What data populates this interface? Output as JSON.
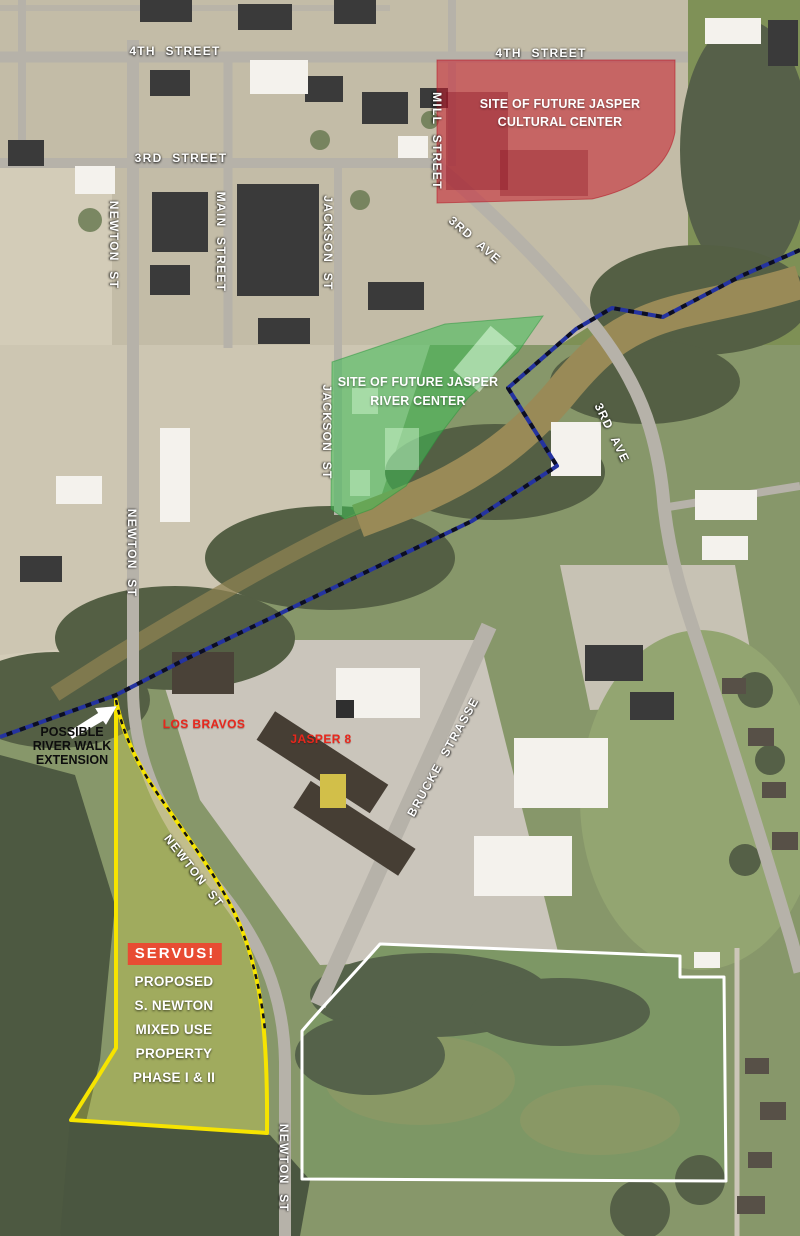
{
  "canvas": {
    "width": 800,
    "height": 1236
  },
  "streets": {
    "fourth_street_west": "4TH STREET",
    "fourth_street_east": "4TH STREET",
    "third_street": "3RD STREET",
    "mill_street": "MILL STREET",
    "main_street": "MAIN STREET",
    "jackson_st_north": "JACKSON ST",
    "jackson_st_south": "JACKSON ST",
    "newton_st_north": "NEWTON ST",
    "newton_st_mid": "NEWTON ST",
    "newton_st_curve": "NEWTON ST",
    "newton_st_south": "NEWTON ST",
    "third_ave_north": "3RD AVE",
    "third_ave_south": "3RD AVE",
    "brucke_strasse": "BRUCKE STRASSE"
  },
  "sites": {
    "cultural_center": {
      "line1": "SITE OF FUTURE JASPER",
      "line2": "CULTURAL CENTER",
      "fill_color": "#c41f30"
    },
    "river_center": {
      "line1": "SITE OF FUTURE JASPER",
      "line2": "RIVER CENTER",
      "fill_color": "#2eb44b"
    },
    "mixed_use_property": {
      "badge": "SERVUS!",
      "badge_color": "#e84c33",
      "lines": [
        "PROPOSED",
        "S. NEWTON",
        "MIXED USE",
        "PROPERTY",
        "PHASE I & II"
      ],
      "outline_color": "#f6e400"
    },
    "white_parcel": {
      "outline_color": "#ffffff"
    }
  },
  "river_walk": {
    "label_line1": "POSSIBLE",
    "label_line2": "RIVER WALK",
    "label_line3": "EXTENSION",
    "path_color": "#2433a0"
  },
  "businesses": {
    "los_bravos": "LOS BRAVOS",
    "jasper_8": "JASPER 8"
  }
}
